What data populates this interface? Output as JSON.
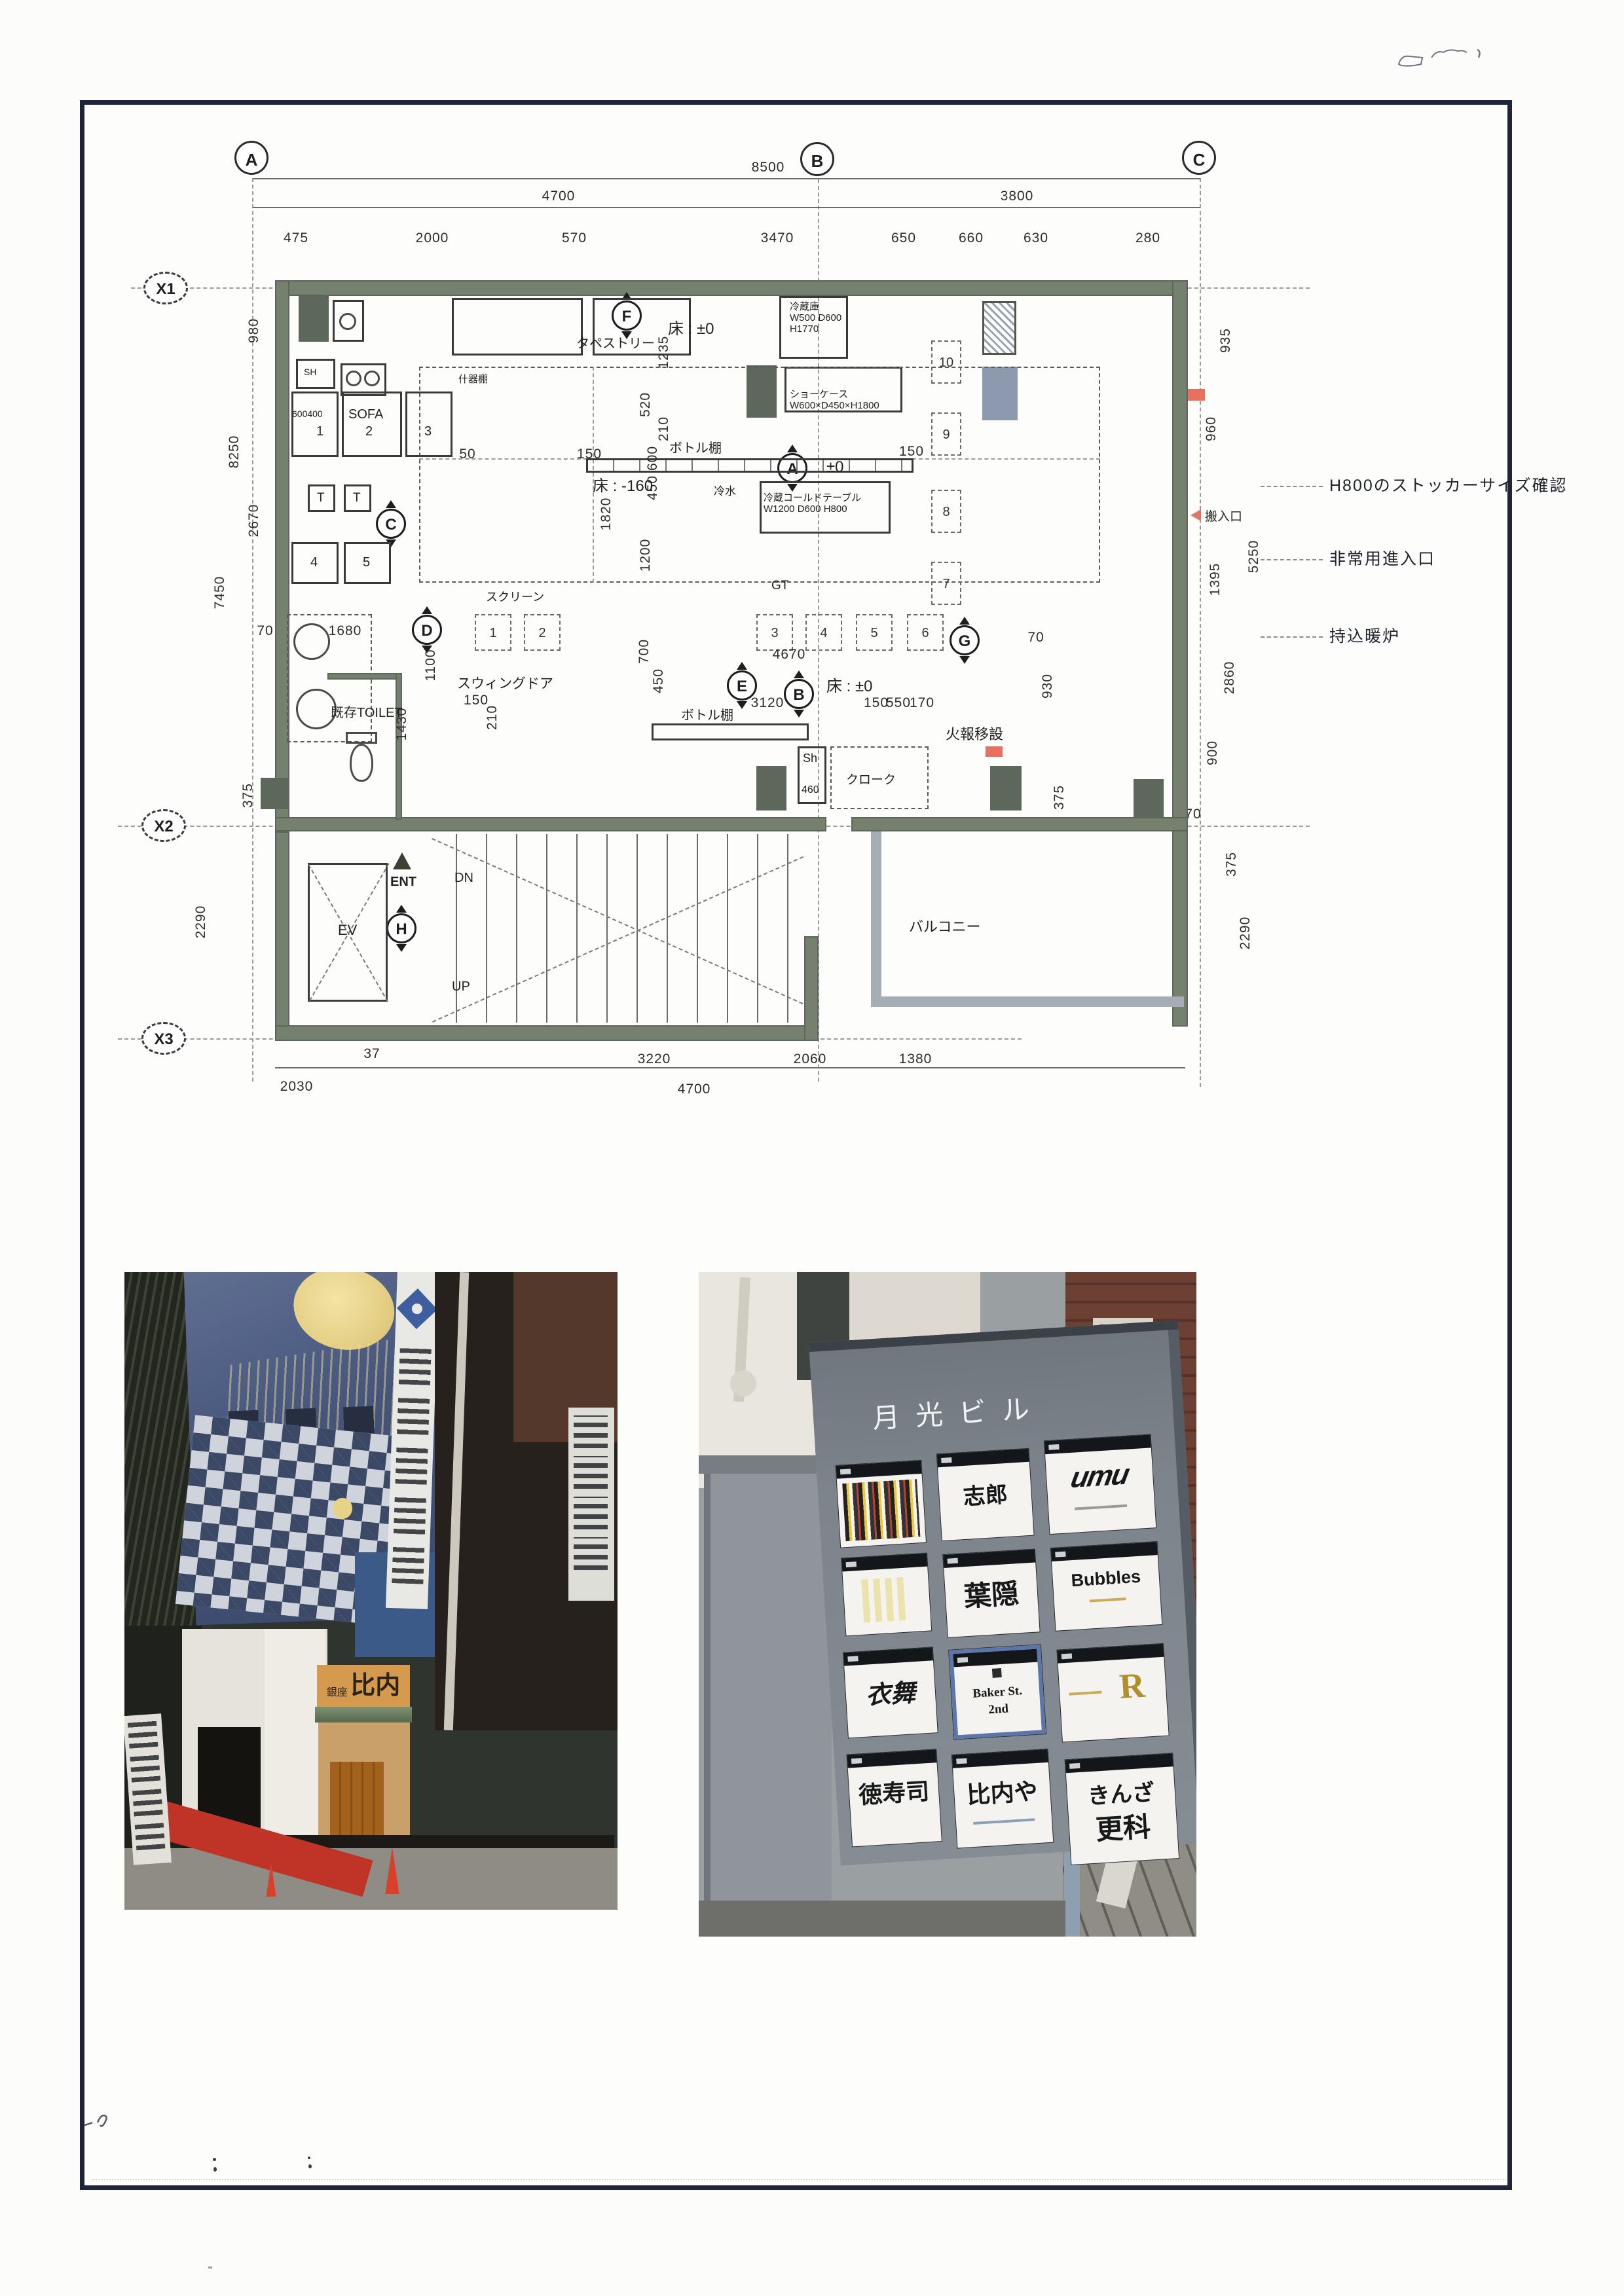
{
  "plan": {
    "grid_cols": [
      "A",
      "B",
      "C"
    ],
    "grid_rows": [
      "X1",
      "X2",
      "X3"
    ],
    "section_marks": [
      "F",
      "C",
      "D",
      "E",
      "B",
      "A",
      "G",
      "H"
    ],
    "dims": {
      "overall_top": "8500",
      "span_ab": "4700",
      "span_bc": "3800",
      "top_detail": [
        "475",
        "2000",
        "570",
        "3470",
        "650",
        "660",
        "630",
        "280"
      ],
      "bottom_row1": [
        "37",
        "3220",
        "2060",
        "1380"
      ],
      "bottom_row2": [
        "2030",
        "4700"
      ],
      "left_col": [
        "980",
        "8250",
        "2670",
        "7450",
        "375",
        "2290"
      ],
      "right_col": [
        "935",
        "960",
        "5250",
        "1395",
        "2860",
        "70",
        "900",
        "375",
        "2290"
      ],
      "inner": [
        "1235",
        "520",
        "210",
        "600",
        "450",
        "1200",
        "1820",
        "700",
        "450",
        "50",
        "150",
        "150",
        "70",
        "1680",
        "1100",
        "1430",
        "150",
        "210",
        "3120",
        "4670",
        "150",
        "550",
        "170",
        "930",
        "70",
        "375"
      ]
    },
    "labels": {
      "tapestry": "タペストリー",
      "floor_f": "床 : ±0",
      "floor_center": "±0",
      "floor_b": "床 : ±0",
      "floor_minus": "床 : -160",
      "bottle_arrow": "ボトル棚",
      "bottle_lower": "ボトル棚",
      "toilet": "既存TOILET",
      "swing_door": "スウィングドア",
      "screen": "スクリーン",
      "gt": "GT",
      "sh": "Sh",
      "sh_size": "460",
      "cloak": "クローク",
      "fire_move": "火報移設",
      "ev": "EV",
      "ent": "ENT",
      "dn": "DN",
      "up": "UP",
      "balcony": "バルコニー",
      "sofa": "SOFA",
      "sofa_dim": "600400",
      "shelf": "SH",
      "cold_water": "冷水",
      "utensil_shelf": "什器棚"
    },
    "equipment": {
      "fridge": [
        "冷蔵庫",
        "W500 D600",
        "H1770"
      ],
      "showcase": [
        "ショーケース",
        "W600×D450×H1800"
      ],
      "cold_table": [
        "冷蔵コールドテーブル",
        "W1200 D600 H800"
      ]
    },
    "seats": {
      "sofa_row": [
        "1",
        "2",
        "3"
      ],
      "tables": [
        "T",
        "T"
      ],
      "sofa_row2": [
        "4",
        "5"
      ],
      "counter": [
        "1",
        "2",
        "3",
        "4",
        "5",
        "6"
      ],
      "right_tables": [
        "10",
        "9",
        "8",
        "7"
      ]
    },
    "notes_right": [
      "H800のストッカーサイズ確認",
      "非常用進入口",
      "持込暖炉"
    ],
    "carry_in_label": "搬入口"
  },
  "photos": {
    "left": {
      "storefront_sign_prefix": "銀座",
      "storefront_sign": "比内や"
    },
    "right": {
      "building_name": "月光ビル",
      "panels": [
        {
          "line1": ""
        },
        {
          "line1": "志郎"
        },
        {
          "line1": "umu"
        },
        {
          "line1": ""
        },
        {
          "line1": "葉隠"
        },
        {
          "line1": "Bubbles"
        },
        {
          "line1": "衣舞"
        },
        {
          "line1": "Baker St.",
          "line2": "2nd"
        },
        {
          "line1": "R"
        },
        {
          "line1": "徳寿司"
        },
        {
          "line1": "比内や"
        },
        {
          "line1": "きんざ",
          "line2": "更科"
        }
      ]
    }
  }
}
